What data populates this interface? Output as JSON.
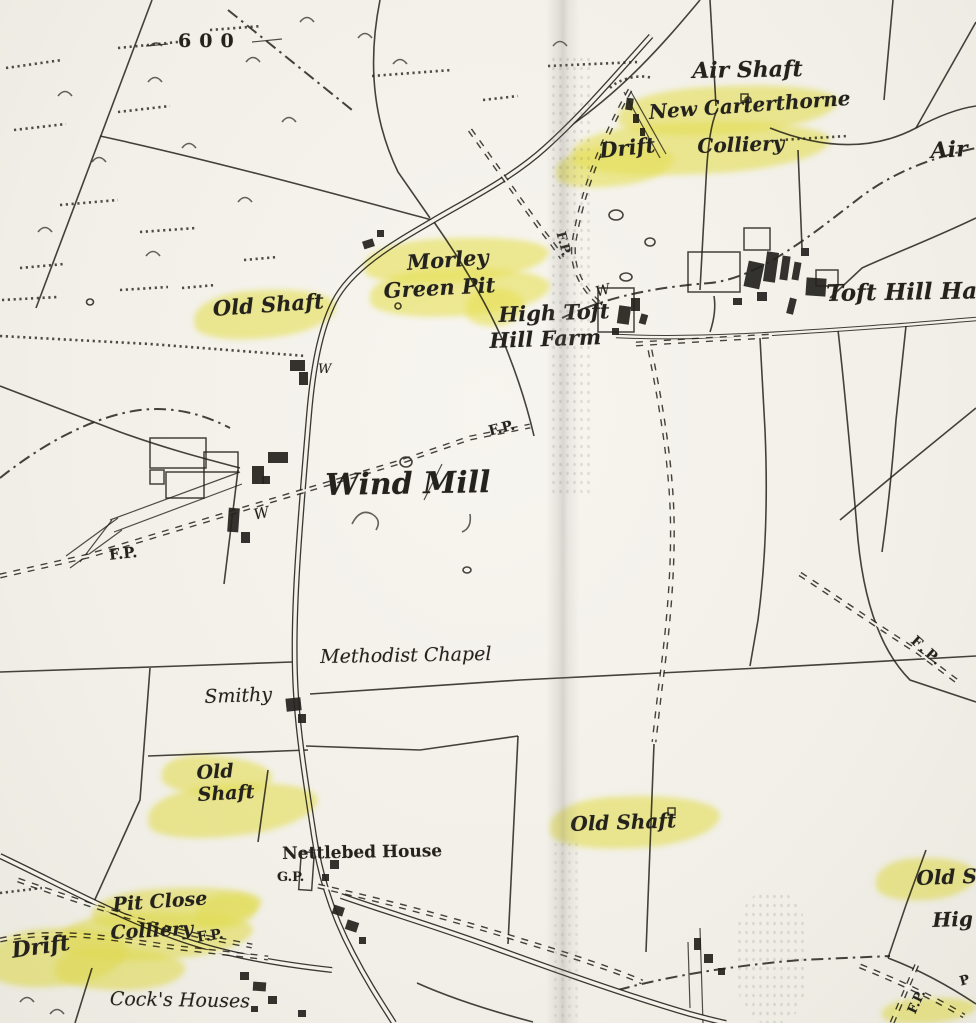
{
  "colors": {
    "paper": "#f3f1ea",
    "ink": "#24221d",
    "highlighter_yellow": "#f0ec5f",
    "fold_gray": "#8a8880"
  },
  "map": {
    "labels": [
      {
        "id": "contour-600",
        "text": "600",
        "x": 178,
        "y": 30,
        "size": 19,
        "style": "roman",
        "ls": 8,
        "rot": 0
      },
      {
        "id": "air-shaft-top",
        "text": "Air Shaft",
        "x": 692,
        "y": 58,
        "size": 22,
        "style": "italic-bold",
        "rot": -1
      },
      {
        "id": "new-carterthorne",
        "text": "New Carterthorne",
        "x": 648,
        "y": 100,
        "size": 20,
        "style": "italic-bold",
        "rot": -4
      },
      {
        "id": "colliery-new-carterthorne",
        "text": "Colliery",
        "x": 697,
        "y": 134,
        "size": 20,
        "style": "italic-bold",
        "rot": -2
      },
      {
        "id": "drift-top",
        "text": "Drift",
        "x": 598,
        "y": 138,
        "size": 21,
        "style": "italic-bold",
        "rot": -6
      },
      {
        "id": "air-right-partial",
        "text": "Air",
        "x": 930,
        "y": 138,
        "size": 22,
        "style": "italic-bold",
        "rot": -3
      },
      {
        "id": "morley",
        "text": "Morley",
        "x": 406,
        "y": 250,
        "size": 21,
        "style": "italic-bold",
        "rot": -4
      },
      {
        "id": "green-pit",
        "text": "Green Pit",
        "x": 383,
        "y": 278,
        "size": 21,
        "style": "italic-bold",
        "rot": -3
      },
      {
        "id": "old-shaft-left",
        "text": "Old Shaft",
        "x": 212,
        "y": 296,
        "size": 21,
        "style": "italic-bold",
        "rot": -4
      },
      {
        "id": "toft-hill-hall",
        "text": "Toft Hill Hall",
        "x": 826,
        "y": 280,
        "size": 23,
        "style": "italic-bold",
        "rot": -1
      },
      {
        "id": "high-toft",
        "text": "High Toft",
        "x": 498,
        "y": 302,
        "size": 21,
        "style": "italic-bold",
        "rot": -2
      },
      {
        "id": "hill-farm",
        "text": "Hill Farm",
        "x": 489,
        "y": 328,
        "size": 21,
        "style": "italic-bold",
        "rot": -2
      },
      {
        "id": "fp-toft",
        "text": "F.P.",
        "x": 567,
        "y": 230,
        "size": 13,
        "style": "roman",
        "rot": 75
      },
      {
        "id": "w-toft",
        "text": "W",
        "x": 594,
        "y": 285,
        "size": 14,
        "style": "italic",
        "rot": -15
      },
      {
        "id": "w-road",
        "text": "W",
        "x": 318,
        "y": 362,
        "size": 13,
        "style": "italic",
        "rot": 0
      },
      {
        "id": "w-windmill",
        "text": "W",
        "x": 252,
        "y": 506,
        "size": 15,
        "style": "italic",
        "rot": -12
      },
      {
        "id": "fp-windmill",
        "text": "F.P.",
        "x": 487,
        "y": 424,
        "size": 14,
        "style": "roman",
        "rot": -14
      },
      {
        "id": "wind-mill",
        "text": "Wind Mill",
        "x": 325,
        "y": 468,
        "size": 30,
        "style": "italic-bold",
        "rot": -1
      },
      {
        "id": "fp-left",
        "text": "F.P.",
        "x": 108,
        "y": 546,
        "size": 15,
        "style": "roman",
        "rot": -6
      },
      {
        "id": "fp-right",
        "text": "F.P.",
        "x": 918,
        "y": 633,
        "size": 14,
        "style": "roman",
        "ls": 3,
        "rot": 42
      },
      {
        "id": "methodist-chapel",
        "text": "Methodist Chapel",
        "x": 320,
        "y": 646,
        "size": 19,
        "style": "italic",
        "rot": -1
      },
      {
        "id": "smithy",
        "text": "Smithy",
        "x": 204,
        "y": 686,
        "size": 19,
        "style": "italic",
        "rot": -2
      },
      {
        "id": "old-shaft-sw",
        "lines": [
          "Old",
          "Shaft"
        ],
        "x": 196,
        "y": 762,
        "size": 19,
        "style": "italic-bold",
        "rot": -3
      },
      {
        "id": "old-shaft-center",
        "text": "Old Shaft",
        "x": 570,
        "y": 812,
        "size": 20,
        "style": "italic-bold",
        "rot": -2
      },
      {
        "id": "nettlebed-house",
        "text": "Nettlebed House",
        "x": 282,
        "y": 844,
        "size": 17,
        "style": "roman",
        "rot": -1
      },
      {
        "id": "gp",
        "text": "G.P.",
        "x": 277,
        "y": 870,
        "size": 13,
        "style": "roman",
        "rot": 0
      },
      {
        "id": "pit-close",
        "text": "Pit Close",
        "x": 112,
        "y": 894,
        "size": 19,
        "style": "italic-bold",
        "rot": -4
      },
      {
        "id": "colliery-pit-close",
        "text": "Colliery",
        "x": 110,
        "y": 922,
        "size": 19,
        "style": "italic-bold",
        "rot": -3
      },
      {
        "id": "fp-pit-close",
        "text": "F.P.",
        "x": 196,
        "y": 930,
        "size": 14,
        "style": "roman",
        "rot": -8
      },
      {
        "id": "drift-sw",
        "text": "Drift",
        "x": 10,
        "y": 938,
        "size": 22,
        "style": "italic-bold",
        "rot": -8
      },
      {
        "id": "cocks-houses",
        "text": "Cock's Houses",
        "x": 110,
        "y": 988,
        "size": 19,
        "style": "italic",
        "rot": 1
      },
      {
        "id": "old-s-right-partial",
        "text": "Old S",
        "x": 916,
        "y": 866,
        "size": 20,
        "style": "italic-bold",
        "rot": -2
      },
      {
        "id": "hig-right-partial",
        "text": "Hig",
        "x": 932,
        "y": 908,
        "size": 20,
        "style": "italic-bold",
        "rot": -2
      },
      {
        "id": "fp-se",
        "text": "F.P.",
        "x": 905,
        "y": 1010,
        "size": 13,
        "style": "roman",
        "rot": -65
      },
      {
        "id": "p-right-partial",
        "text": "P",
        "x": 958,
        "y": 975,
        "size": 13,
        "style": "roman",
        "rot": -15
      }
    ],
    "highlighter_marks": [
      {
        "x": 618,
        "y": 86,
        "w": 220,
        "h": 48,
        "rot": -3
      },
      {
        "x": 572,
        "y": 122,
        "w": 258,
        "h": 52,
        "rot": -2
      },
      {
        "x": 556,
        "y": 146,
        "w": 118,
        "h": 40,
        "rot": -5
      },
      {
        "x": 364,
        "y": 238,
        "w": 185,
        "h": 44,
        "rot": -3
      },
      {
        "x": 370,
        "y": 268,
        "w": 180,
        "h": 48,
        "rot": -2
      },
      {
        "x": 466,
        "y": 288,
        "w": 58,
        "h": 38,
        "rot": 0
      },
      {
        "x": 194,
        "y": 290,
        "w": 142,
        "h": 48,
        "rot": -4
      },
      {
        "x": 162,
        "y": 756,
        "w": 110,
        "h": 40,
        "rot": 4
      },
      {
        "x": 148,
        "y": 784,
        "w": 170,
        "h": 52,
        "rot": -5
      },
      {
        "x": 550,
        "y": 796,
        "w": 170,
        "h": 52,
        "rot": -2
      },
      {
        "x": 92,
        "y": 888,
        "w": 170,
        "h": 42,
        "rot": -3
      },
      {
        "x": 58,
        "y": 912,
        "w": 195,
        "h": 48,
        "rot": -2
      },
      {
        "x": 196,
        "y": 894,
        "w": 62,
        "h": 34,
        "rot": -8
      },
      {
        "x": -12,
        "y": 928,
        "w": 140,
        "h": 58,
        "rot": -4
      },
      {
        "x": 55,
        "y": 948,
        "w": 130,
        "h": 42,
        "rot": 2
      },
      {
        "x": 876,
        "y": 858,
        "w": 100,
        "h": 42,
        "rot": -2
      },
      {
        "x": 882,
        "y": 998,
        "w": 94,
        "h": 25,
        "rot": -3
      }
    ]
  }
}
